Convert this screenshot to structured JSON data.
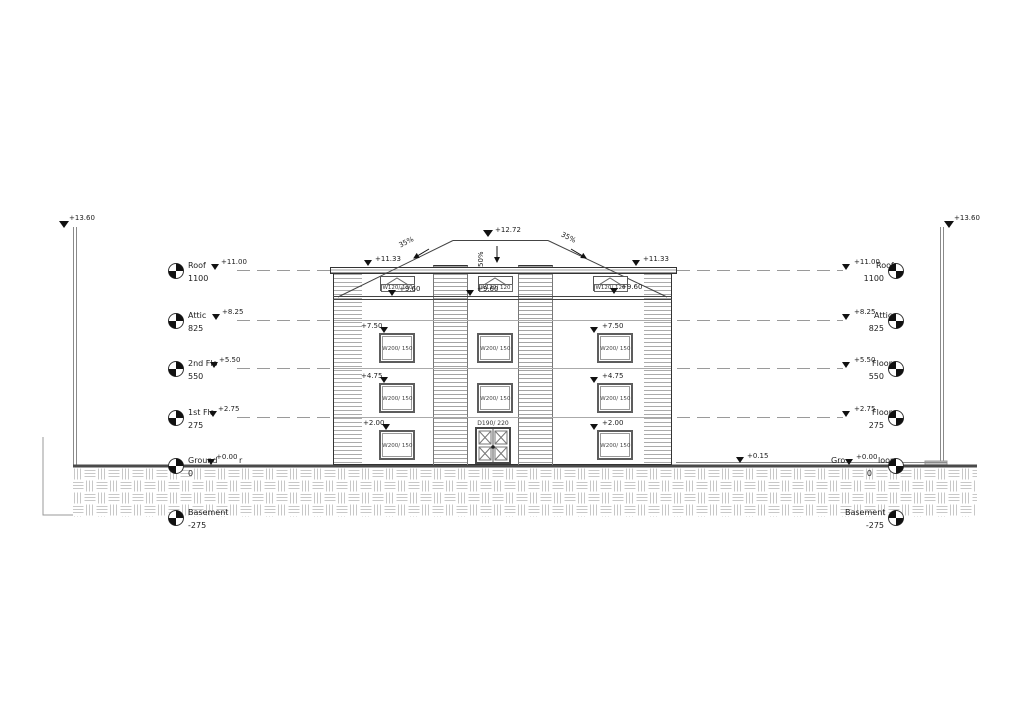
{
  "markers": {
    "stake_elev": "+13.60",
    "ridge_elev": "+12.72",
    "slope_left": "35%",
    "slope_right": "35%",
    "slope_center": "50%",
    "eave_elev": "+11.33",
    "attic_sill_elev": "+9.60",
    "floor3_window_elev": "+7.50",
    "floor2_window_elev": "+4.75",
    "ground_window_elev": "+2.00",
    "grade_elev": "+0.15"
  },
  "levels_left": [
    {
      "name": "Roof",
      "elev": "+11.00",
      "value": "1100"
    },
    {
      "name": "Attic",
      "elev": "+8.25",
      "value": "825"
    },
    {
      "name": "2nd Flo",
      "elev": "+5.50",
      "value": "550"
    },
    {
      "name": "1st Flo",
      "elev": "+2.75",
      "value": "275"
    },
    {
      "name": "Ground",
      "elev": "+0.00",
      "suffix": "r",
      "value": "0"
    },
    {
      "name": "Basement",
      "value": "-275"
    }
  ],
  "levels_right": [
    {
      "elev": "+11.00",
      "name": "Roof",
      "value": "1100"
    },
    {
      "elev": "+8.25",
      "name": "Attic",
      "value": "825"
    },
    {
      "elev": "+5.50",
      "name": "Floor",
      "value": "550"
    },
    {
      "elev": "+2.75",
      "name": "Floor",
      "value": "275"
    },
    {
      "prefix": "Gro",
      "elev": "+0.00",
      "name": "loor",
      "value": "0"
    },
    {
      "name": "Basement",
      "value": "-275"
    }
  ],
  "openings": {
    "window_label": "W200/ 150",
    "attic_window_label": "W120/ 120",
    "door_label": "D190/ 220"
  }
}
